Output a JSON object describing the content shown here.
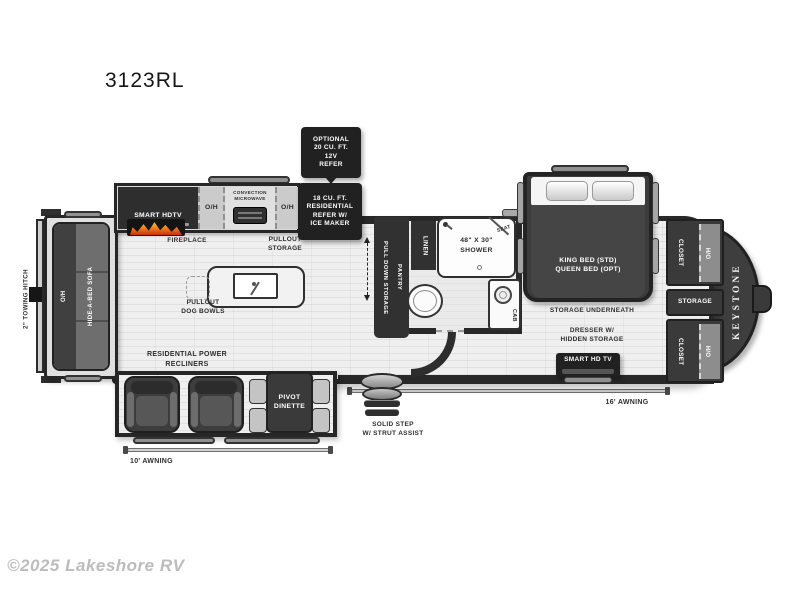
{
  "title": "3123RL",
  "copyright": "©2025 Lakeshore RV",
  "colors": {
    "wall": "#282828",
    "black_box": "#212121",
    "floor": "#ebebeb",
    "flame_orange": "#f07818",
    "text_dark": "#2d2d2d",
    "text_light": "#ffffff"
  },
  "exterior": {
    "towing_hitch": "2\" TOWING HITCH",
    "awning_left": "10' AWNING",
    "awning_right": "16' AWNING",
    "step_line1": "SOLID STEP",
    "step_line2": "W/ STRUT ASSIST",
    "brand": "KEYSTONE"
  },
  "living": {
    "sofa_oh": "O/H",
    "sofa": "HIDE-A-BED SOFA",
    "tv": "SMART HDTV",
    "fireplace": "FIREPLACE",
    "recliners_line1": "RESIDENTIAL POWER",
    "recliners_line2": "RECLINERS",
    "dinette_line1": "PIVOT",
    "dinette_line2": "DINETTE"
  },
  "kitchen": {
    "oh": "O/H",
    "microwave_line1": "CONVECTION",
    "microwave_line2": "MICROWAVE",
    "pullout_line1": "PULLOUT",
    "pullout_line2": "STORAGE",
    "dogbowls_line1": "PULLOUT",
    "dogbowls_line2": "DOG BOWLS",
    "refer_line1": "18 CU. FT.",
    "refer_line2": "RESIDENTIAL",
    "refer_line3": "REFER W/",
    "refer_line4": "ICE MAKER",
    "optrefer_line1": "OPTIONAL",
    "optrefer_line2": "20 CU. FT.",
    "optrefer_line3": "12V",
    "optrefer_line4": "REFER",
    "pantry_line1": "PULL DOWN STORAGE",
    "pantry_line2": "PANTRY"
  },
  "bathroom": {
    "linen": "LINEN",
    "shower_line1": "48\" X 30\"",
    "shower_line2": "SHOWER",
    "seat": "SEAT",
    "cab": "CAB"
  },
  "bedroom": {
    "bed_line1": "KING BED (STD)",
    "bed_line2": "QUEEN BED (OPT)",
    "storage_underneath": "STORAGE UNDERNEATH",
    "dresser_line1": "DRESSER W/",
    "dresser_line2": "HIDDEN STORAGE",
    "tv": "SMART HD TV",
    "closet": "CLOSET",
    "oh": "O/H",
    "storage": "STORAGE"
  }
}
